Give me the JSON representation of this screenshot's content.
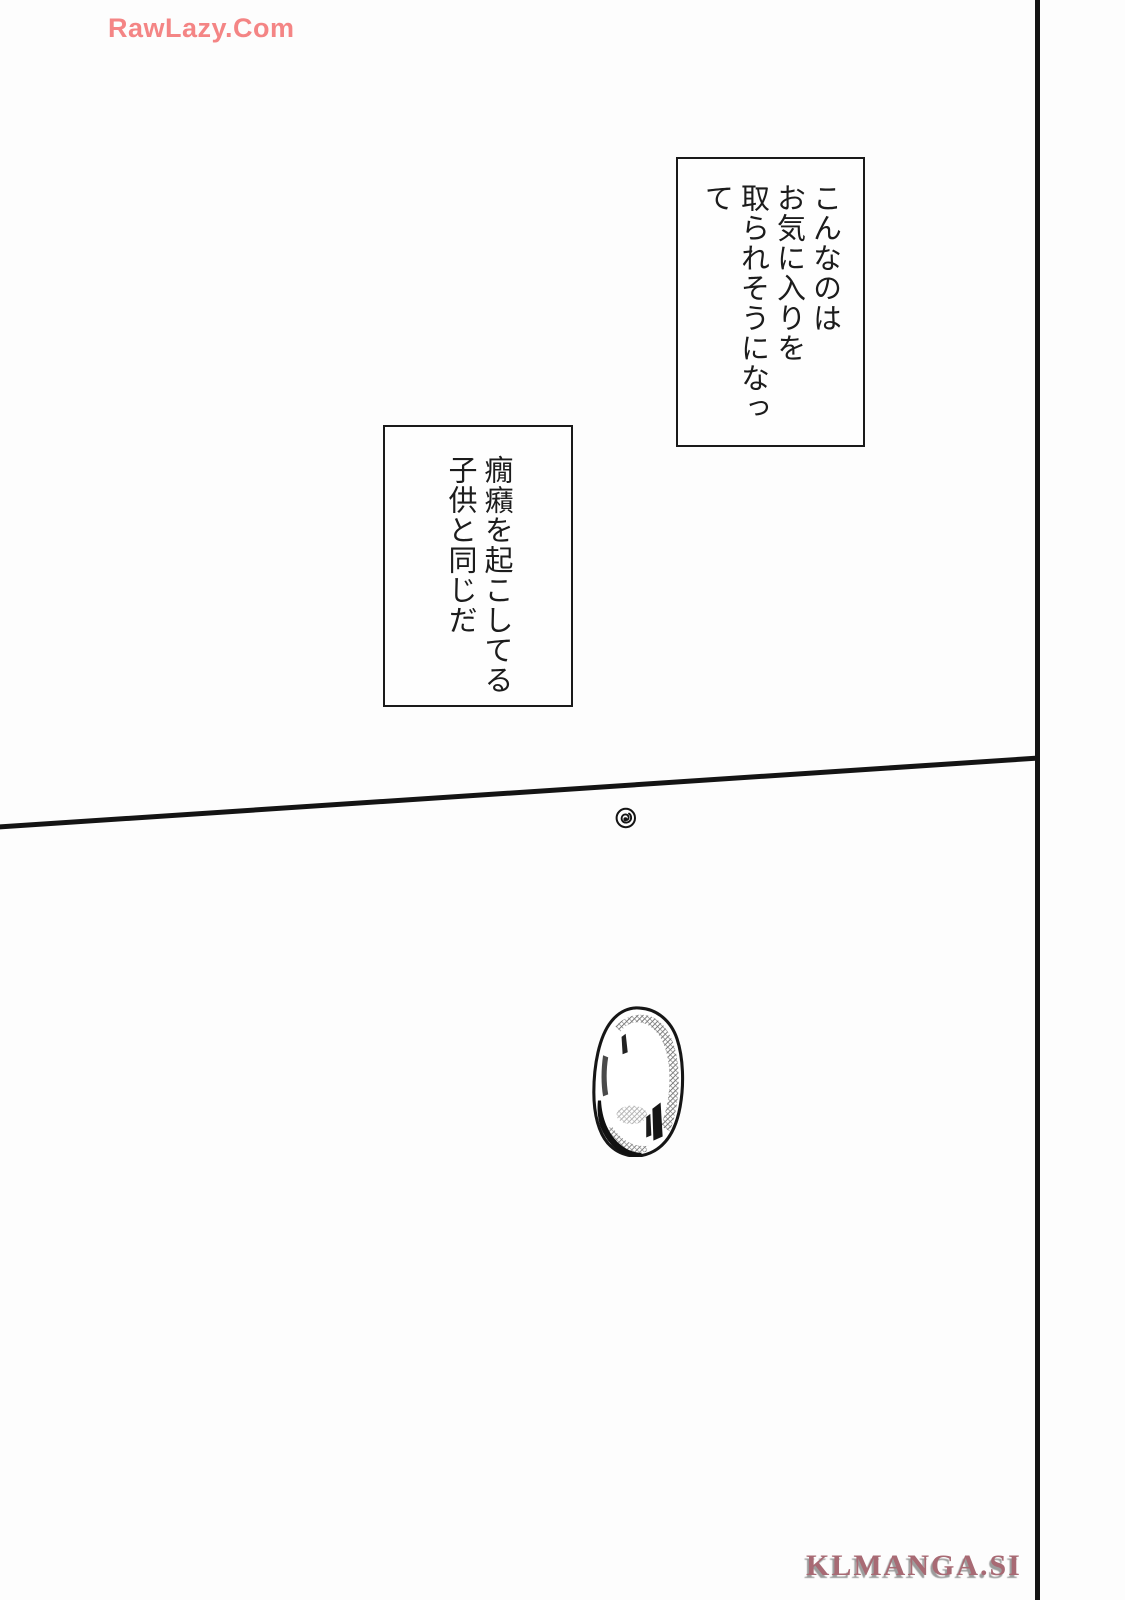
{
  "page": {
    "kind": "manga page",
    "background": "#fdfdfd",
    "ink_color": "#141414"
  },
  "watermarks": {
    "top": {
      "text": "RawLazy.Com",
      "color": "#f48585"
    },
    "bottom": {
      "text": "KLMANGA.SI",
      "color": "#a86a74"
    }
  },
  "speech_boxes": [
    {
      "position": "upper-right",
      "lines": [
        "こんなのは",
        "お気に入りを",
        "取られそうになって"
      ]
    },
    {
      "position": "upper-middle-left",
      "lines": [
        "癇癪を起こしてる",
        "子供と同じだ"
      ]
    }
  ],
  "artwork": {
    "panel_borders": [
      "vertical-line-right",
      "diagonal-line-across-middle"
    ],
    "marks": [
      "swirl-mark-below-diagonal",
      "toned-oval-egg-object-lower-middle"
    ]
  }
}
